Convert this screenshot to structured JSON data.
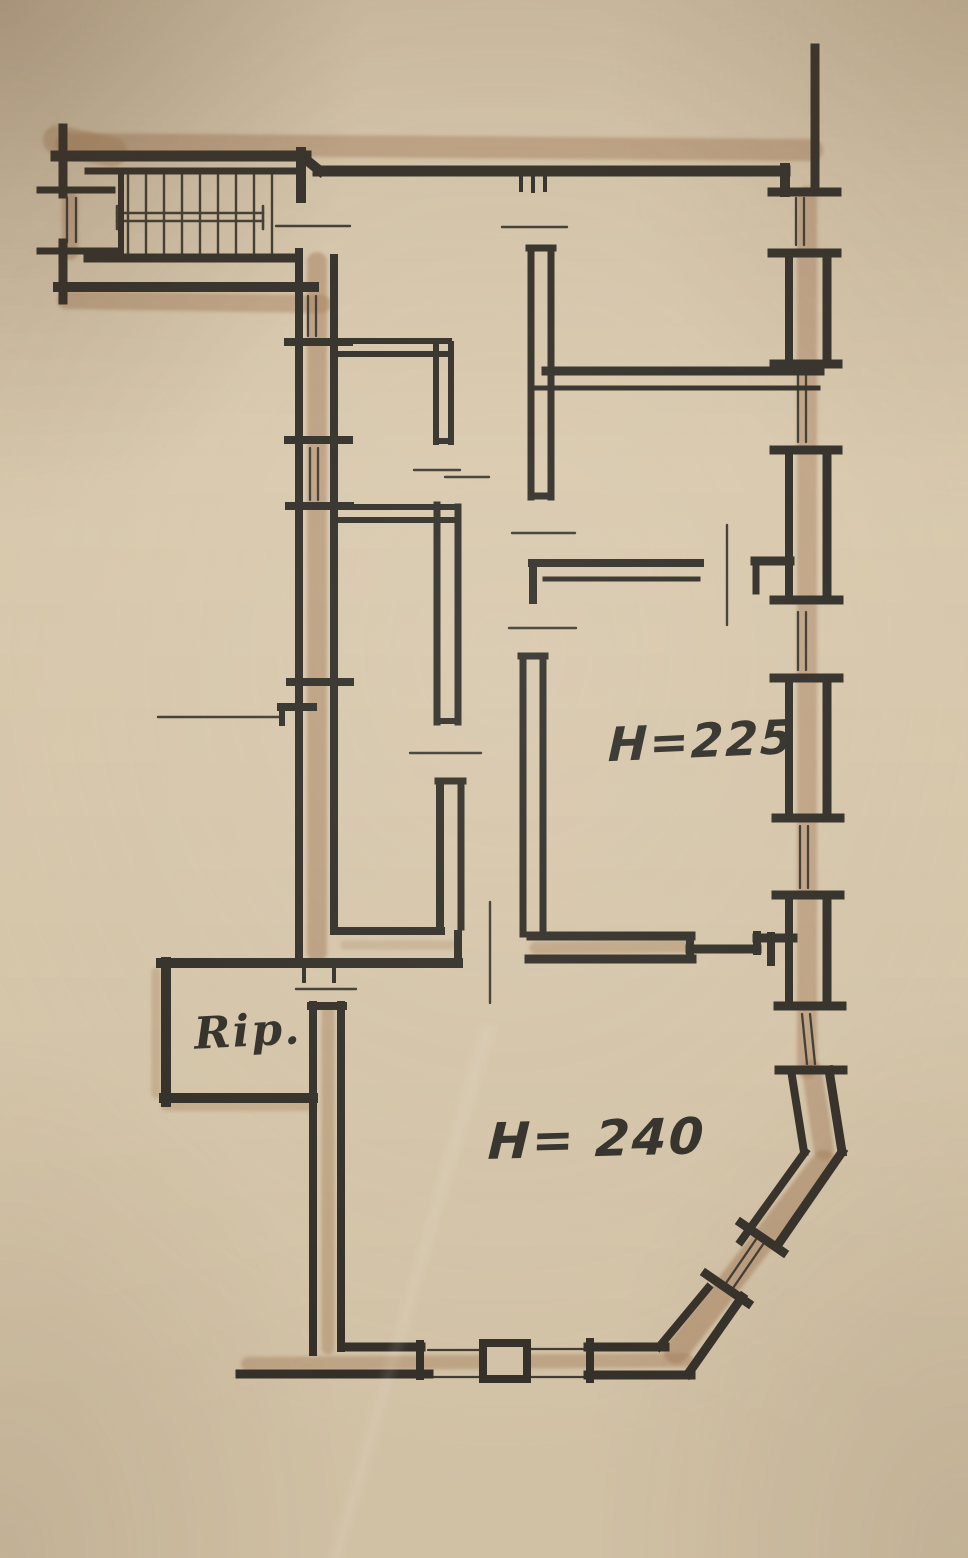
{
  "page": {
    "description": "Hand-drawn apartment floor plan sketch in ink and pencil on beige paper"
  },
  "labels": {
    "height_upper_room": "H=225",
    "height_lower_room": "H= 240",
    "storage_room": "Rip."
  },
  "colors": {
    "paper": "#d8c8ac",
    "ink": "#2d2a24",
    "pencil_shading": "#a8805c"
  }
}
